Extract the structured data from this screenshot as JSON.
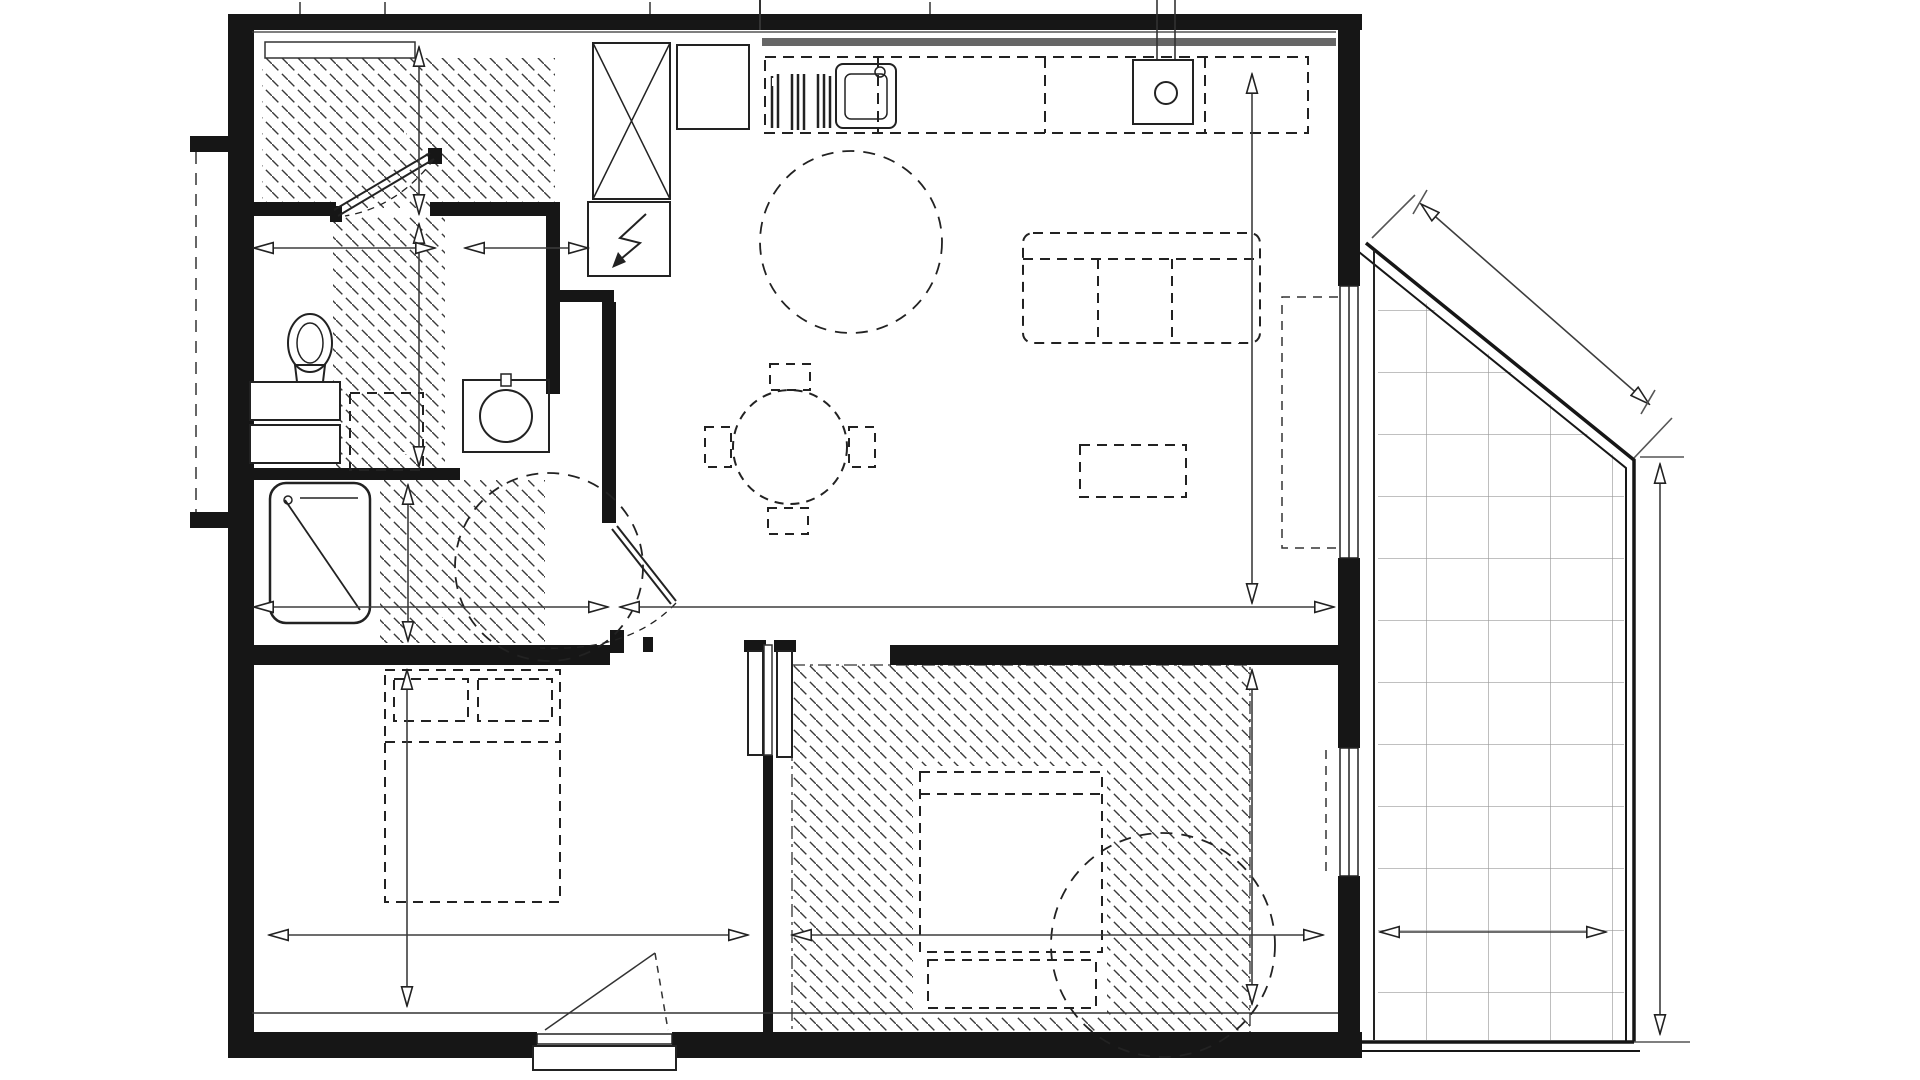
{
  "rooms": {
    "entree": "ENTREE",
    "sejour_cuisine": "SEJOUR/CUISINE",
    "wc": "WC.",
    "sdb": "SDB",
    "chambre2": "CHAMBRE 2",
    "chambre1": "CHAMBRE 1",
    "balcon": "BALCON"
  },
  "fixtures": {
    "placard": "PL",
    "refrigerateur": "R",
    "lave_vaisselle": "LV",
    "cuisine": "CUI",
    "chauffe_eau": "CH",
    "machine_laver": "ML",
    "pf_sejour": "PF",
    "pf_chambre": "PF",
    "fenetre_avant": "F AV",
    "gc": "GC"
  },
  "dimensions": {
    "entree_depth": "1,42",
    "wc_width": "1,50",
    "entry_passage": "1,00",
    "wc_depth": "2,07",
    "sejour_depth": "4,66",
    "sdb_width": "2,80",
    "sejour_width": "5,75",
    "sdb_depth": "1,43",
    "chambre2_depth": "2,82",
    "chambre2_width": "4,04",
    "chambre1_depth": "2,82",
    "chambre1_width": "4,51",
    "balcon_diagonal": "2,57",
    "balcon_length": "4,75",
    "balcon_width": "1,92"
  }
}
